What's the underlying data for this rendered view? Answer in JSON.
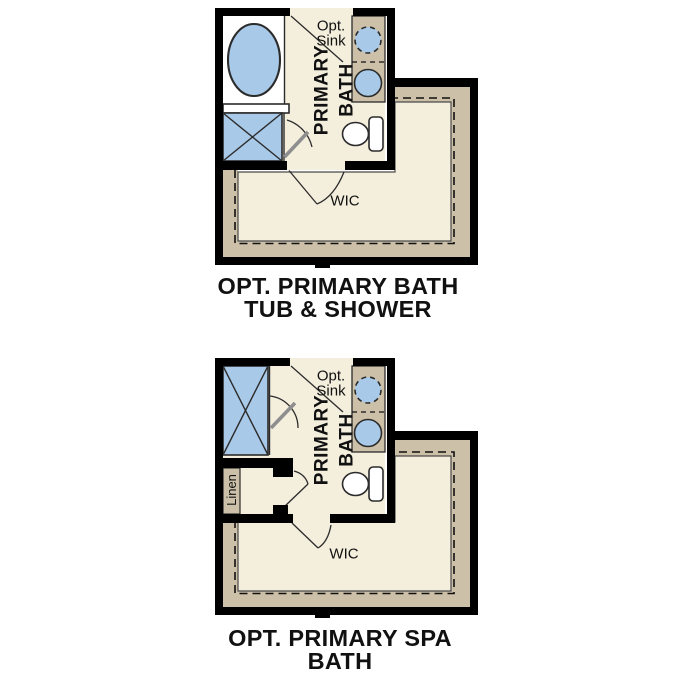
{
  "colors": {
    "wall": "#000000",
    "floor": "#f4eedd",
    "tan": "#ccc1a8",
    "fixture": "#a9c9e8",
    "outline": "#2b2b2b",
    "leaf": "#8e8e8e",
    "text": "#111111",
    "white": "#ffffff",
    "page_bg": "#ffffff"
  },
  "diagrams": [
    {
      "title_line1": "OPT. PRIMARY BATH",
      "title_line2": "TUB & SHOWER",
      "room_label_line1": "PRIMARY",
      "room_label_line2": "BATH",
      "opt_sink_line1": "Opt.",
      "opt_sink_line2": "Sink",
      "wic_label": "WIC"
    },
    {
      "title_line1": "OPT. PRIMARY SPA",
      "title_line2": "BATH",
      "room_label_line1": "PRIMARY",
      "room_label_line2": "BATH",
      "opt_sink_line1": "Opt.",
      "opt_sink_line2": "Sink",
      "wic_label": "WIC",
      "linen_label": "Linen"
    }
  ]
}
